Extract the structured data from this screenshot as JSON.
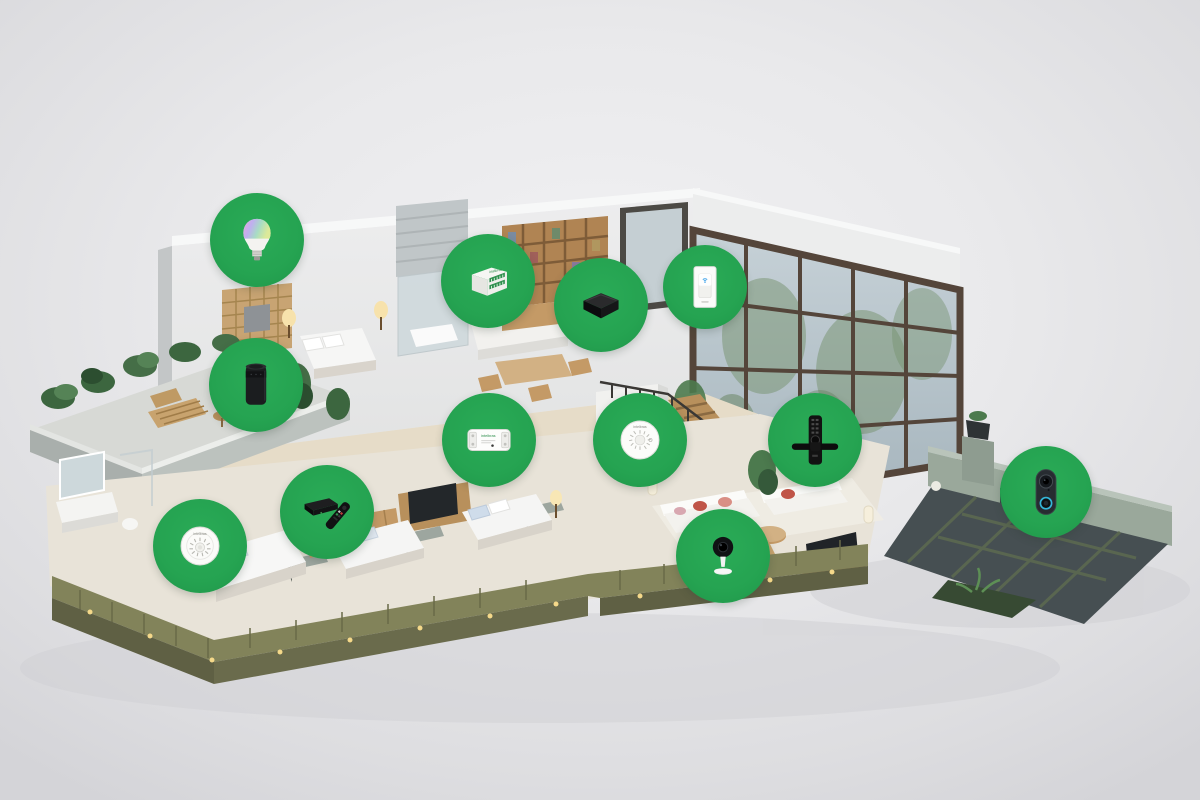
{
  "scene": {
    "kind": "isometric-smart-home-cutaway",
    "floors_visible": 2,
    "device_badge_count": 12
  },
  "colors": {
    "badge_green": "#25A351",
    "background_light": "#F1F1F3",
    "background_edge": "#D4D4D8",
    "glass_blue": "#B7C4CB",
    "wood": "#C49A66",
    "deck_olive": "#82835A",
    "courtyard_tile": "#464F52"
  },
  "devices": [
    {
      "id": "smart-bulb",
      "icon": "smart-bulb-icon"
    },
    {
      "id": "relay-module",
      "icon": "relay-module-icon",
      "brand": "intelbras"
    },
    {
      "id": "ir-control-box",
      "icon": "ir-control-box-icon"
    },
    {
      "id": "smart-wall-switch",
      "icon": "smart-wall-switch-icon"
    },
    {
      "id": "smart-speaker",
      "icon": "smart-speaker-icon"
    },
    {
      "id": "wifi-smart-relay",
      "icon": "wifi-relay-icon",
      "brand": "intelbras"
    },
    {
      "id": "smart-siren",
      "icon": "smart-siren-icon",
      "brand": "intelbras"
    },
    {
      "id": "smart-door-lock",
      "icon": "smart-lock-icon"
    },
    {
      "id": "smart-tv-box",
      "icon": "tv-box-remote-icon"
    },
    {
      "id": "smoke-detector",
      "icon": "smoke-detector-icon",
      "brand": "intelbras"
    },
    {
      "id": "indoor-camera",
      "icon": "indoor-camera-icon"
    },
    {
      "id": "video-doorbell",
      "icon": "video-doorbell-icon"
    }
  ]
}
